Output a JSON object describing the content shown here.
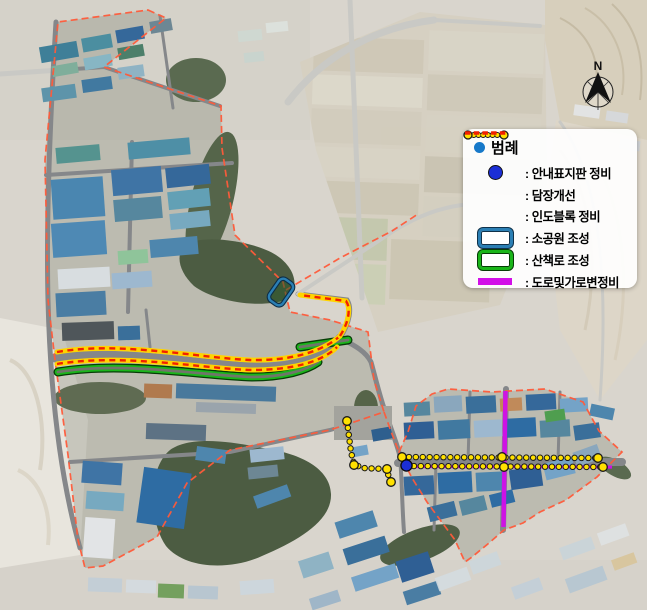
{
  "legend": {
    "title": "범례",
    "items": [
      {
        "label": ": 안내표지판 정비",
        "marker": "blue-circle"
      },
      {
        "label": ": 담장개선",
        "marker": "yellow-dotted-line"
      },
      {
        "label": ": 인도블록 정비",
        "marker": "red-dashed-line"
      },
      {
        "label": ": 소공원 조성",
        "marker": "blue-rounded-rect"
      },
      {
        "label": ": 산책로 조성",
        "marker": "green-rounded-rect"
      },
      {
        "label": ": 도로및가로변정비",
        "marker": "magenta-line"
      }
    ]
  },
  "compass": {
    "label": "N"
  },
  "colors": {
    "legend_bullet": "#1779c9",
    "signboard": "#1b2ed6",
    "fence_dot": "#ffe000",
    "sidewalk_dash": "#f22000",
    "sidewalk_base": "#ffd400",
    "park_border": "#2b7fb4",
    "trail_green": "#1ab51a",
    "road_magenta": "#d20fe8",
    "boundary": "#ff5b3a"
  }
}
